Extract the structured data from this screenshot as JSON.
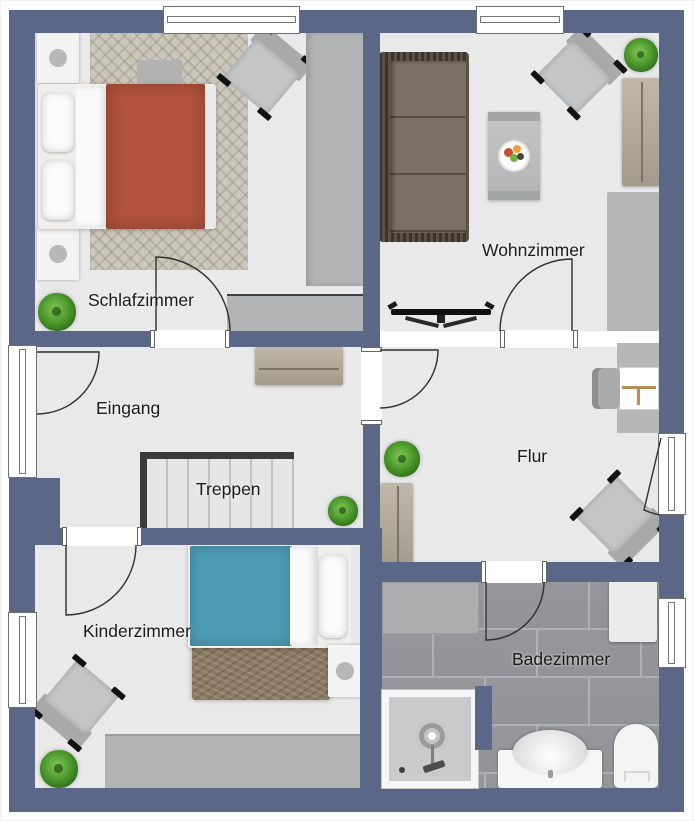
{
  "floorplan": {
    "rooms": [
      {
        "name": "Schlafzimmer",
        "furniture": [
          "double-bed",
          "nightstand",
          "nightstand",
          "armchair",
          "wardrobe",
          "dresser",
          "herringbone-rug",
          "plant",
          "bed-bench"
        ]
      },
      {
        "name": "Wohnzimmer",
        "furniture": [
          "wicker-sofa",
          "coffee-table",
          "fruit-bowl",
          "armchair",
          "sideboard",
          "rug",
          "tv",
          "plant"
        ]
      },
      {
        "name": "Eingang",
        "furniture": [
          "sideboard",
          "plant",
          "entrance-door"
        ]
      },
      {
        "name": "Treppen",
        "furniture": [
          "staircase"
        ]
      },
      {
        "name": "Flur",
        "furniture": [
          "desk",
          "desk-chair",
          "sideboard",
          "armchair",
          "plant",
          "balcony-door"
        ]
      },
      {
        "name": "Kinderzimmer",
        "furniture": [
          "single-bed",
          "nightstand",
          "shag-rug",
          "armchair",
          "wardrobe",
          "plant"
        ]
      },
      {
        "name": "Badezimmer",
        "furniture": [
          "shower",
          "sink",
          "toilet",
          "cabinet",
          "bath-mat"
        ]
      }
    ],
    "colors": {
      "wall": "#5b6787",
      "floor": "#e9e9ea",
      "tile": "#929398",
      "grout": "#b0b1b4",
      "bed_duvet": "#b0523c",
      "kids_duvet": "#4e9cb4",
      "stairs_border": "#3b3b3b",
      "furniture_gray": "#b1b3b5",
      "furniture_beige": "#b3aa9b",
      "sofa_wicker_dark": "#3c342b",
      "sofa_wicker_light": "#5c5143",
      "sofa_cushion": "#7d7165",
      "carpet_beige": "#cbc7ba",
      "rug_brown": "#8b7b63",
      "rug_gray": "#b4b6b8",
      "plant_green": "#4c9a2e",
      "arc_line": "#2f2f2f",
      "label": "#1b1b1b"
    }
  }
}
